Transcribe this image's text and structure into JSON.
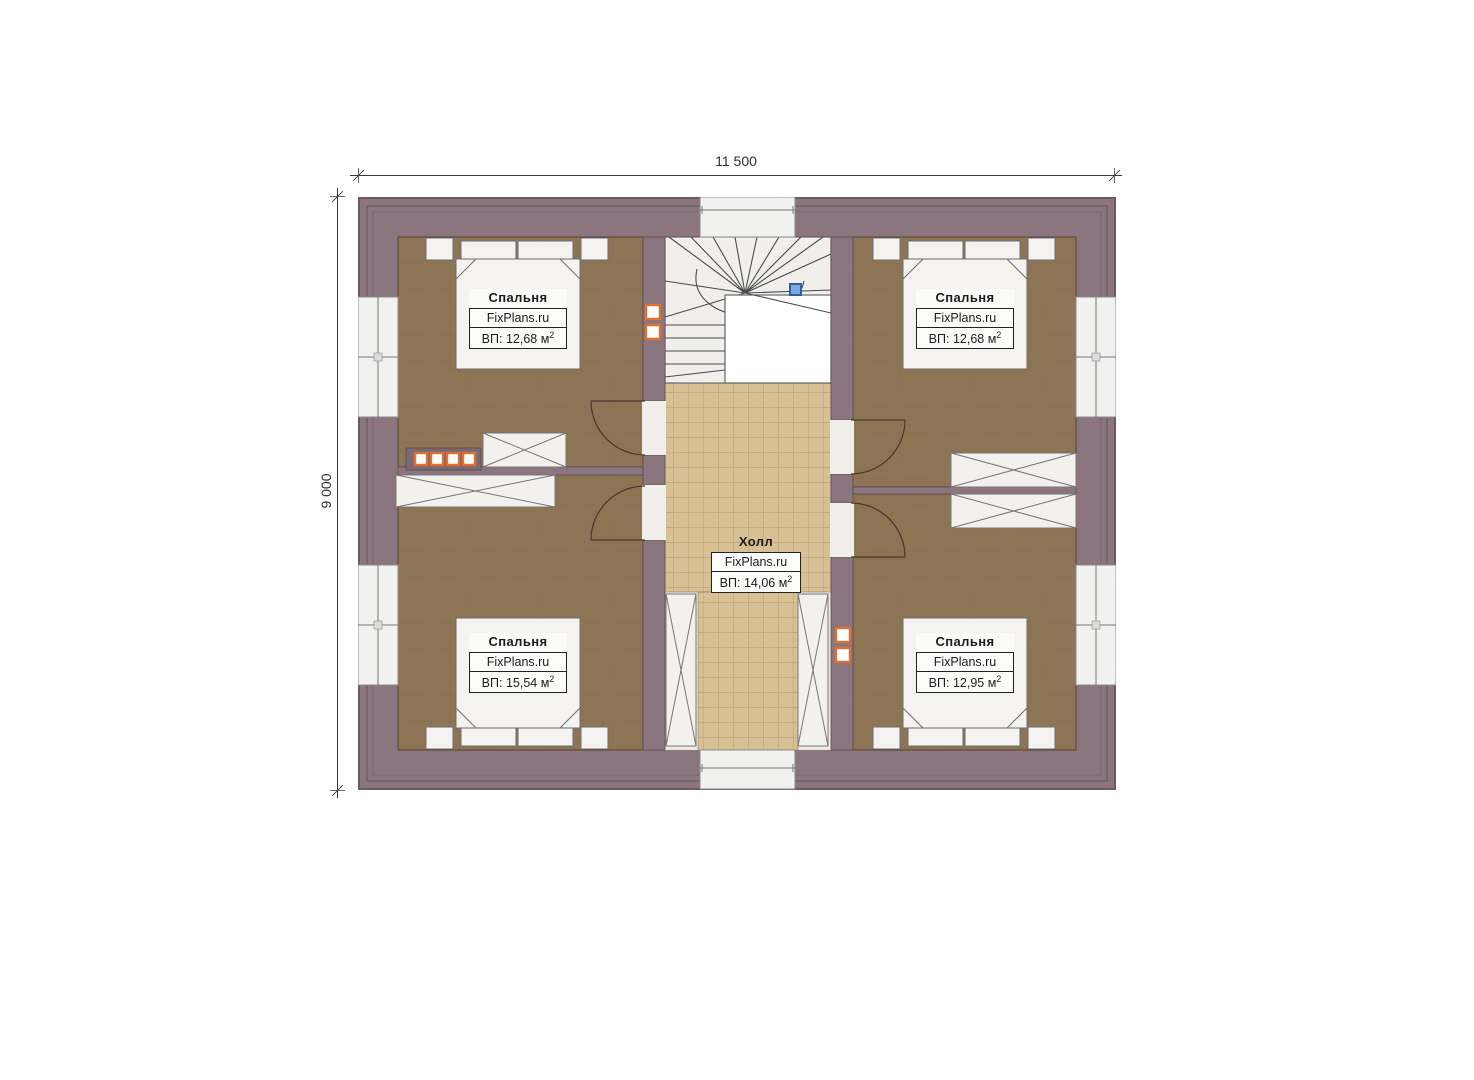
{
  "dimension_labels": {
    "width": "11 500",
    "height": "9 000"
  },
  "rooms": {
    "bedroom_top_left": {
      "name": "Спальня",
      "brand": "FixPlans.ru",
      "area": "ВП: 12,68 м",
      "area_sup": "2"
    },
    "bedroom_top_right": {
      "name": "Спальня",
      "brand": "FixPlans.ru",
      "area": "ВП: 12,68 м",
      "area_sup": "2"
    },
    "bedroom_bottom_left": {
      "name": "Спальня",
      "brand": "FixPlans.ru",
      "area": "ВП: 15,54 м",
      "area_sup": "2"
    },
    "bedroom_bottom_right": {
      "name": "Спальня",
      "brand": "FixPlans.ru",
      "area": "ВП: 12,95 м",
      "area_sup": "2"
    },
    "hall": {
      "name": "Холл",
      "brand": "FixPlans.ru",
      "area": "ВП: 14,06 м",
      "area_sup": "2"
    }
  },
  "colors": {
    "wall": "#8b757e",
    "bedroom_floor": "#8d7454",
    "hall_floor": "#d8c095",
    "furniture": "#f2f1ee",
    "radiator_accent": "#e0702f",
    "stair_marker_blue": "#7fa8dd"
  }
}
